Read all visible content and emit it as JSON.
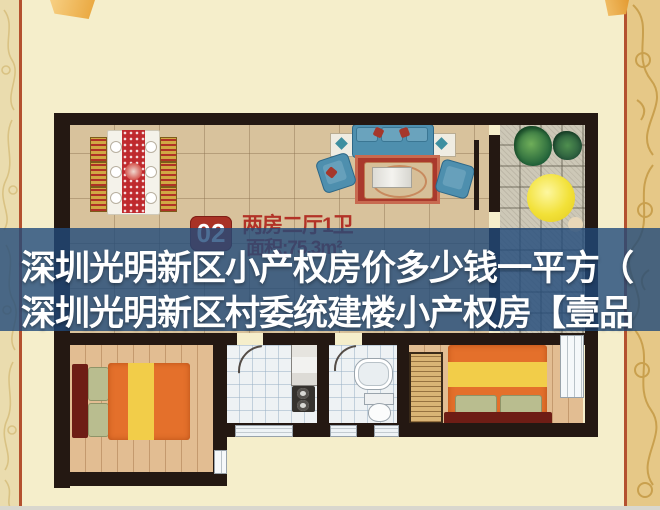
{
  "caption": {
    "line1": "深圳光明新区小产权房价多少钱一平方（",
    "line2": "深圳光明新区村委统建楼小产权房【壹品",
    "text_color": "#ffffff",
    "overlay_color": "rgba(32,74,122,0.8)"
  },
  "floorplan": {
    "unit_badge": "02",
    "unit_type": "两房二厅1卫",
    "unit_area": "面积:75.3m²",
    "badge_color": "#a93226",
    "label_color": "#b23227",
    "wall_color": "#241812"
  },
  "page": {
    "background_color": "#f5eecb",
    "accent_line_color": "#b4512f",
    "left_border_color": "#eadcae",
    "right_border_color": "#e6c887",
    "ribbon_color": "#e9a53b"
  }
}
